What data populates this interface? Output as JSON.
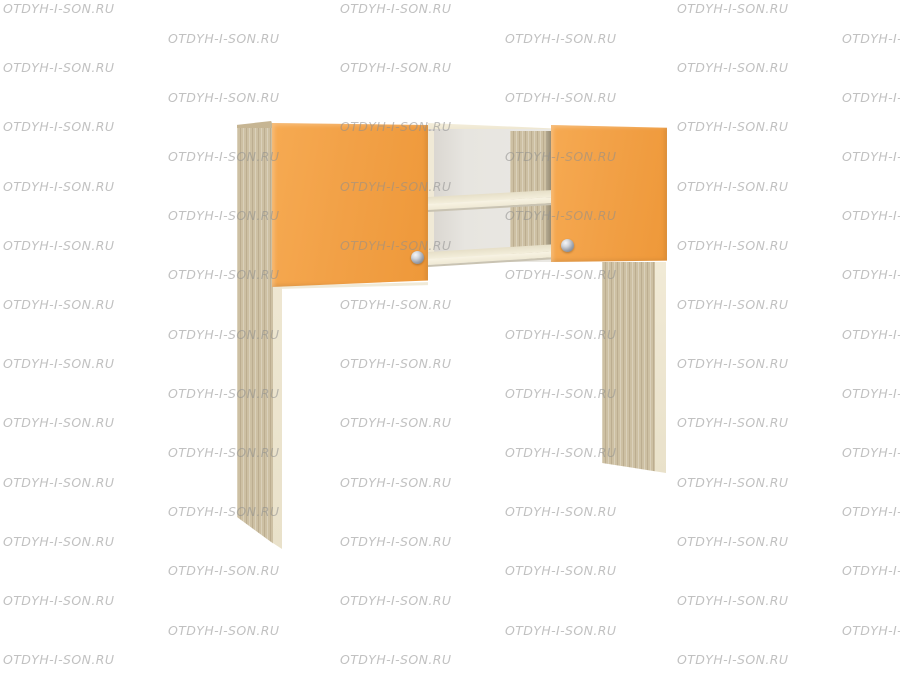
{
  "page": {
    "background": "#ffffff",
    "description_label": "furniture product photo: desk hutch with two orange doors and open shelves"
  },
  "watermark": {
    "text": "OTDYH-I-SON.RU",
    "color": "#8d8d8d",
    "opacity": 0.55,
    "rows": 23,
    "row_spacing": 29.6,
    "col_spacing": 337,
    "even_row_x": 3,
    "odd_row_x": 168,
    "cols_per_row": 3
  },
  "product": {
    "colors": {
      "door_orange": "#f2a149",
      "wood_panel": "#cdc0a3",
      "edge_cream": "#efe8d3",
      "back_panel": "#e8e6e2",
      "knob_silver": "#9aa0aa",
      "shelf_front": "#f6f1df"
    },
    "parts": {
      "left_door": "orange cabinet door with round silver knob",
      "right_door": "orange cabinet door with round silver knob",
      "open_shelf": "middle open section with one shelf",
      "left_leg": "tall wood side panel",
      "right_leg": "wood support panel"
    }
  }
}
